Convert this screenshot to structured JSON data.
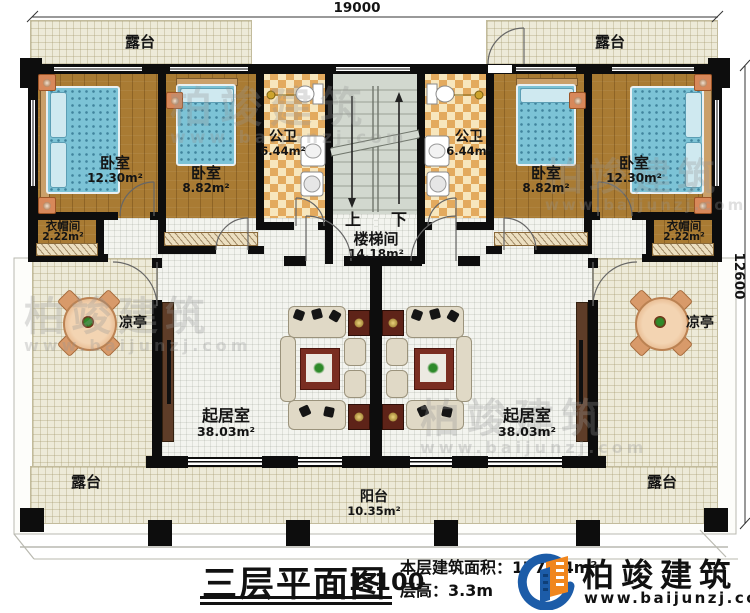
{
  "dimensions": {
    "top": "19000",
    "right": "12600"
  },
  "rooms": {
    "terrace_tl": {
      "label": "露台"
    },
    "terrace_tr": {
      "label": "露台"
    },
    "bedroom_l1": {
      "label": "卧室",
      "area": "12.30m²"
    },
    "bedroom_l2": {
      "label": "卧室",
      "area": "8.82m²"
    },
    "bath_l": {
      "label": "公卫",
      "area": "6.44m²"
    },
    "stairwell": {
      "label": "楼梯间",
      "area": "14.18m²",
      "up": "上",
      "down": "下"
    },
    "bath_r": {
      "label": "公卫",
      "area": "6.44m²"
    },
    "bedroom_r2": {
      "label": "卧室",
      "area": "8.82m²"
    },
    "bedroom_r1": {
      "label": "卧室",
      "area": "12.30m²"
    },
    "cloak_l": {
      "label": "衣帽间",
      "area": "2.22m²"
    },
    "cloak_r": {
      "label": "衣帽间",
      "area": "2.22m²"
    },
    "pavilion_l": {
      "label": "凉亭"
    },
    "pavilion_r": {
      "label": "凉亭"
    },
    "living_l": {
      "label": "起居室",
      "area": "38.03m²"
    },
    "living_r": {
      "label": "起居室",
      "area": "38.03m²"
    },
    "terrace_bl": {
      "label": "露台"
    },
    "terrace_br": {
      "label": "露台"
    },
    "balcony": {
      "label": "阳台",
      "area": "10.35m²"
    }
  },
  "titleblock": {
    "title": "三层平面图",
    "scale": "1:100",
    "area_label": "本层建筑面积：",
    "area_value": "177.14m²",
    "floor_height_label": "层高：",
    "floor_height_value": "3.3m"
  },
  "brand": {
    "name": "柏竣建筑",
    "url": "www.baijunzj.com"
  },
  "colors": {
    "wall": "#0d0d0d",
    "wood_floor": "#a97b33",
    "terrace_floor": "#edead8",
    "checker_tile": "#e3aa5e",
    "bed_blue": "#7cc3d6",
    "rug_red": "#7a2e22",
    "logo_blue": "#1c5ca8",
    "logo_orange": "#f0861e"
  }
}
